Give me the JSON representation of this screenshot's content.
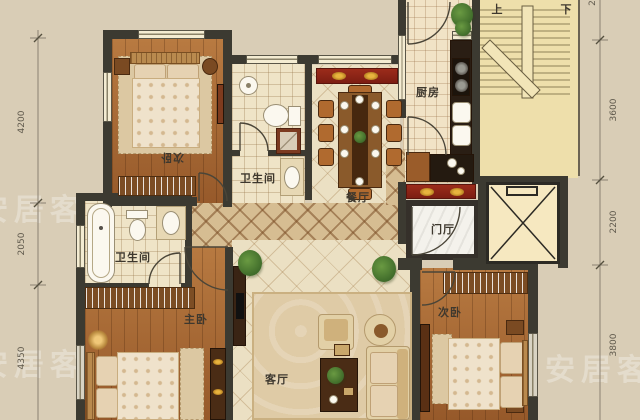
{
  "plan": {
    "rooms": {
      "bedroom_top": "次卧",
      "bath_top": "卫生间",
      "dining": "餐厅",
      "kitchen": "厨房",
      "entry": "门厅",
      "bath_mid": "卫生间",
      "master": "主卧",
      "living": "客厅",
      "bedroom_bottom": "次卧"
    },
    "stairs": {
      "up": "上",
      "down": "下"
    },
    "dimensions": {
      "left": [
        "4200",
        "2050",
        "4350"
      ],
      "right": [
        "3600",
        "2200",
        "3800"
      ],
      "top_right_partial": "2"
    },
    "watermark": "安居客",
    "colors": {
      "background": "#d9cdb6",
      "wall": "#3c3a31",
      "wood_floor": "#a96a33",
      "tile_floor": "#ebe0c3",
      "hallway_lattice": "#d6bd92",
      "stairs_floor": "#eedfab",
      "cabinet_red": "#8c2217",
      "accent_gold": "#d8a435",
      "dimension_text": "#5f594c"
    }
  }
}
